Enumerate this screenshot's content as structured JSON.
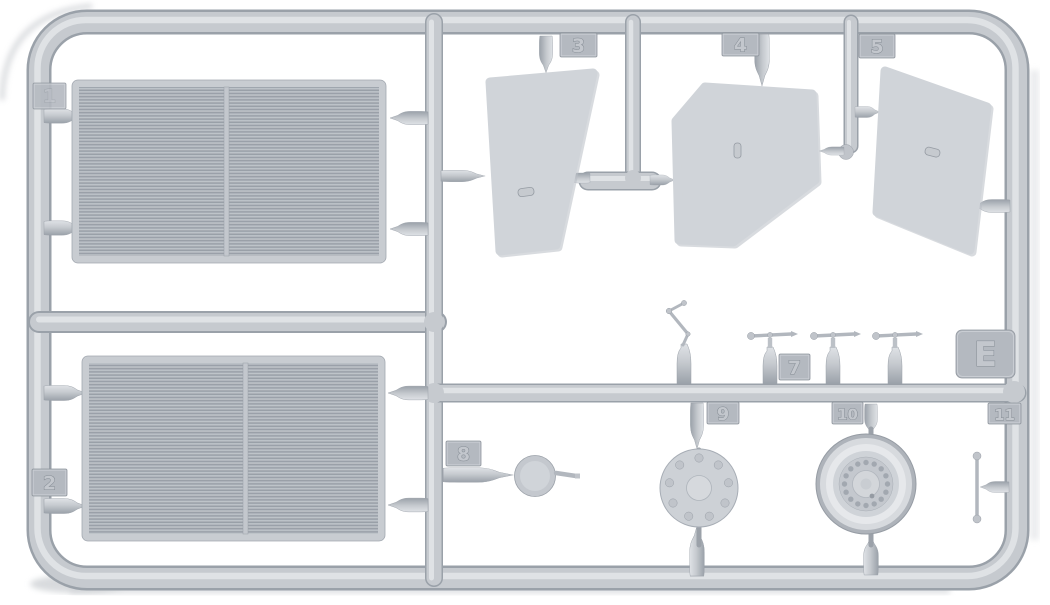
{
  "sprue": {
    "colors": {
      "background": "#ffffff",
      "plastic": "#c6cacf",
      "plastic_highlight": "#e3e6e9",
      "plastic_shadow": "#9aa1a9",
      "panel": "#d0d4d9",
      "radiator_core": "#b1b6bd",
      "tag": "#b4b9c0"
    },
    "tags": {
      "t1": "1",
      "t2": "2",
      "t3": "3",
      "t4": "4",
      "t5": "5",
      "t7": "7",
      "t8": "8",
      "t9": "9",
      "t10": "10",
      "t11": "11",
      "tE": "E"
    }
  }
}
